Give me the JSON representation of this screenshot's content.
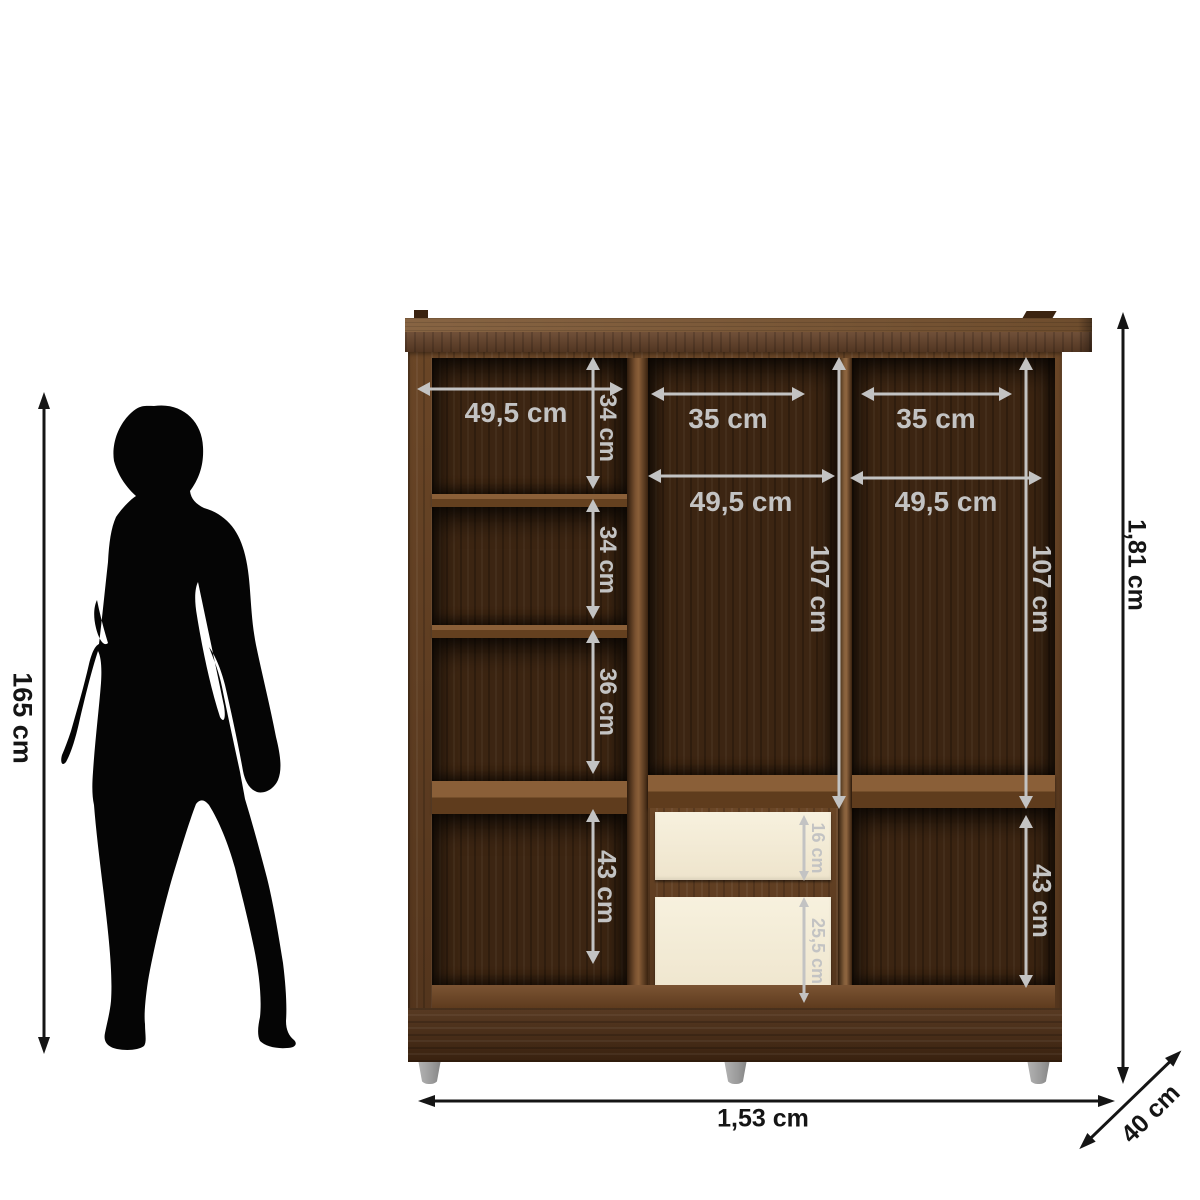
{
  "figure": {
    "person_height": "165 cm"
  },
  "wardrobe": {
    "left_column": {
      "width": "49,5 cm",
      "shelf_1": "34 cm",
      "shelf_2": "34 cm",
      "shelf_3": "36 cm",
      "shelf_4": "43 cm"
    },
    "middle_section": {
      "rod_width": "35 cm",
      "width": "49,5 cm",
      "hanging_height": "107 cm",
      "drawer_top": "16 cm",
      "drawer_bottom": "25,5 cm"
    },
    "right_section": {
      "rod_width": "35 cm",
      "width": "49,5 cm",
      "hanging_height": "107 cm",
      "bottom_cell": "43 cm"
    },
    "overall": {
      "width": "1,53 cm",
      "height": "1,81 cm",
      "depth": "40 cm"
    }
  },
  "colors": {
    "dimension_gray": "#c3c3c3",
    "dimension_black": "#151515",
    "wood_frame": "#5f3d21",
    "wood_interior": "#3c2512",
    "drawer_cream": "#f3ecd8",
    "feet_gray": "#a3a3a3",
    "silhouette_black": "#050505"
  }
}
